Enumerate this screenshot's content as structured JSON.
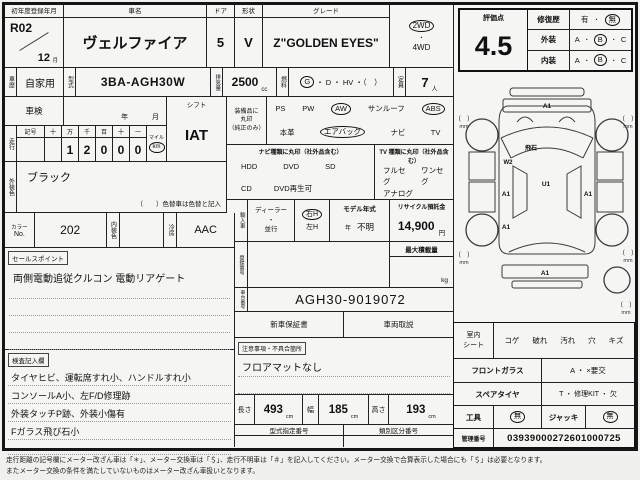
{
  "top": {
    "reg": {
      "label": "初年度登録年月",
      "year": "R02",
      "month": "12",
      "month_unit": "月"
    },
    "car_name": {
      "label": "車名",
      "value": "ヴェルファイア"
    },
    "door": {
      "label": "ドア",
      "value": "5"
    },
    "shape": {
      "label": "形状",
      "value": "V"
    },
    "grade": {
      "label": "グレード",
      "value": "Z\"GOLDEN EYES\""
    },
    "drive": {
      "opt1": "2WD",
      "dot": "・",
      "opt2": "4WD"
    }
  },
  "row2": {
    "history": {
      "label": "車歴",
      "value": "自家用"
    },
    "model_code": {
      "label": "型式",
      "value": "3BA-AGH30W"
    },
    "displacement": {
      "label": "排気量",
      "value": "2500",
      "unit": "cc"
    },
    "fuel": {
      "label": "燃料",
      "g": "G",
      "rest": "・ D ・ HV ・（　）"
    },
    "capacity": {
      "label": "定員",
      "value": "7",
      "unit": "人"
    }
  },
  "shaken": {
    "label": "車検",
    "year_unit": "年",
    "month_unit": "月"
  },
  "shift": {
    "label": "シフト",
    "value": "IAT"
  },
  "equipment": {
    "label1": "装備品に",
    "label2": "丸印",
    "label3": "（純正のみ）",
    "row1": [
      "PS",
      "PW",
      "AW",
      "サンルーフ",
      "ABS"
    ],
    "row2": [
      "本革",
      "エアバッグ",
      "ナビ",
      "TV"
    ]
  },
  "mileage": {
    "label": "走行",
    "headers": [
      "記号",
      "十",
      "万",
      "千",
      "百",
      "十",
      "一"
    ],
    "digits": [
      "",
      "",
      "1",
      "2",
      "0",
      "0",
      "0"
    ],
    "mile": "マイル",
    "km": "km"
  },
  "nav": {
    "header": "ナビ種類に丸印（社外品含む）",
    "row1": [
      "HDD",
      "DVD",
      "SD"
    ],
    "row2": [
      "CD",
      "DVD再生可"
    ]
  },
  "tv": {
    "header": "TV 種類に丸印（社外品含む）",
    "row1": [
      "フルセグ",
      "ワンセグ"
    ],
    "row2": [
      "アナログ"
    ]
  },
  "exterior_color": {
    "label": "外装色",
    "value": "ブラック",
    "note": "（　　）色替車は色替と記入"
  },
  "color_row": {
    "color_no_label1": "カラー",
    "color_no_label2": "No.",
    "color_no": "202",
    "interior_label": "内装色",
    "cooling_label": "冷房",
    "cooling": "AAC"
  },
  "import": {
    "label": "輸入車",
    "dealer": "ディーラー",
    "dot": "・",
    "parallel": "並行",
    "rh": "右H",
    "lh": "左H",
    "model_year": {
      "label": "モデル年式",
      "year_unit": "年",
      "value": "不明"
    },
    "recycle": {
      "label": "リサイクル預託金",
      "value": "14,900",
      "unit": "円"
    }
  },
  "registration": {
    "label": "登録番号",
    "max_load_label": "最大積載量",
    "max_load_unit": "kg"
  },
  "chassis": {
    "label": "車台番号",
    "value": "AGH30-9019072"
  },
  "sales_point": {
    "label": "セールスポイント",
    "text": "両側電動追従クルコン 電動リアゲート"
  },
  "docs": {
    "warranty": "新車保証書",
    "manual": "車両取説"
  },
  "notes": {
    "label": "注意事項・不具合箇所",
    "text": "フロアマットなし"
  },
  "inspection_notes": {
    "label": "検査記入欄",
    "lines": [
      "タイヤヒビ、運転席すれ小、ハンドルすれ小",
      "コンソールA小、左F/D修理跡",
      "外装タッチP跡、外装小傷有",
      "Fガラス飛び石小"
    ]
  },
  "dimensions": {
    "length": {
      "label": "長さ",
      "value": "493",
      "unit": "cm"
    },
    "width": {
      "label": "幅",
      "value": "185",
      "unit": "cm"
    },
    "height": {
      "label": "高さ",
      "value": "193",
      "unit": "cm"
    }
  },
  "type_numbers": {
    "designation": "型式指定番号",
    "classification": "類別区分番号"
  },
  "rating": {
    "label": "評価点",
    "score": "4.5",
    "repair": {
      "label": "修復歴",
      "yes": "有",
      "dot": "・",
      "no": "無"
    },
    "exterior": {
      "label": "外装",
      "a": "A",
      "b": "B",
      "c": "C",
      "dot": "・"
    },
    "interior": {
      "label": "内装",
      "a": "A",
      "b": "B",
      "c": "C",
      "dot": "・"
    }
  },
  "diagram": {
    "front_bumper": "A1",
    "windshield": "飛石",
    "left_door": "W2",
    "roof": "U1",
    "left_slide": "A1",
    "right_slide": "A1",
    "left_quarter": "A1",
    "rear_bumper": "A1",
    "tread": "(　)",
    "mm": "mm"
  },
  "condition": {
    "seat": {
      "label1": "室内",
      "label2": "シート",
      "options": [
        "コゲ",
        "破れ",
        "汚れ",
        "穴",
        "キズ"
      ]
    },
    "front_glass": {
      "label": "フロントガラス",
      "value": "A ・ ×要交"
    },
    "spare": {
      "label": "スペアタイヤ",
      "value": "T ・ 修理KIT ・ 欠"
    },
    "tools": {
      "label": "工具",
      "value": "無",
      "jack_label": "ジャッキ",
      "jack_value": "無"
    },
    "control": {
      "label": "管理番号",
      "value": "03939000272601000725"
    }
  },
  "footer": {
    "line1": "走行距離の記号欄にメーター改ざん車は「＊」、メーター交換車は「＄」、走行不明車は「＃」を記入してください。メーター交換で合算表示した場合にも「＄」は必要となります。",
    "line2": "またメーター交換の条件を満たしていないものはメーター改ざん車扱いとなります。"
  }
}
